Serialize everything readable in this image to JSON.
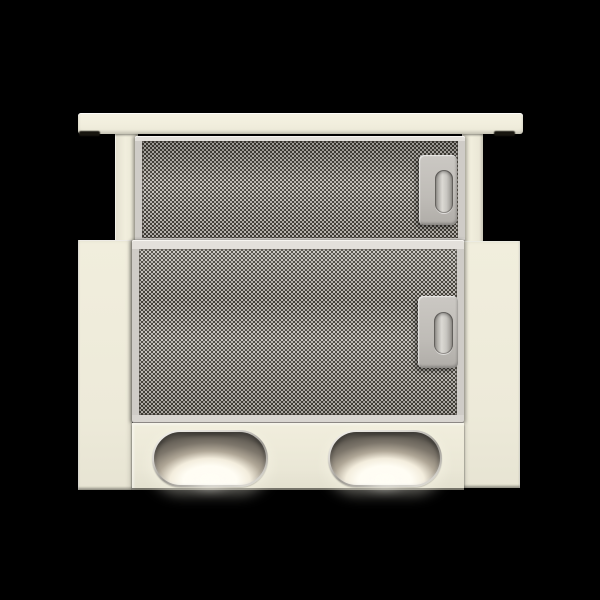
{
  "scene": {
    "type": "product-photo",
    "subject": "telescopic slide-out kitchen cooker hood, cream finish, front view",
    "background": "solid black",
    "filters": {
      "count": 2,
      "style": "aluminium knurled mesh grease filters in metal frames",
      "latch_count": 2
    },
    "lamps": {
      "count": 2,
      "shape": "oval / stadium recess with chrome rim",
      "state": "on",
      "glow": "bright warm-white glow at lower half of each lamp"
    }
  },
  "colors": {
    "background": "#000000",
    "body_cream": "#f1eedd",
    "body_cream_light": "#f5f2e3",
    "frame_metal": "#cfccc7",
    "frame_metal_light": "#e3e0db",
    "mesh_dark": "#45423a",
    "mesh_light": "#c9c5bf",
    "latch_grey": "#bfbcb7",
    "lamp_rim": "#d9d6d0",
    "lamp_smoke": "#5f5a52",
    "lamp_glow": "#fffdf4"
  }
}
